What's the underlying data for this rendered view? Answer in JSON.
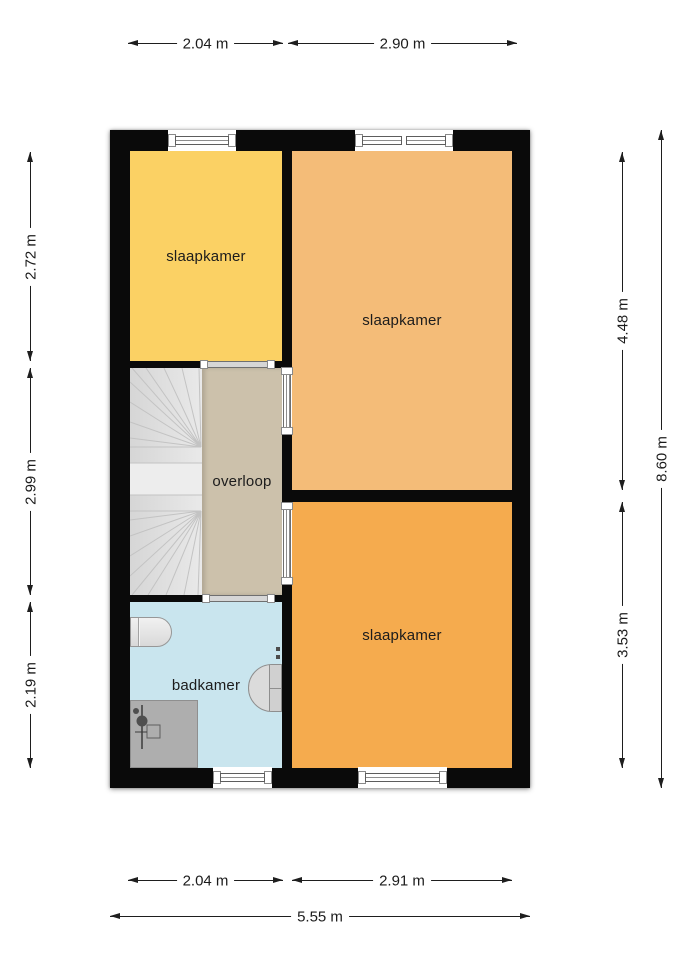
{
  "plan": {
    "type": "floor-plan",
    "wall_color": "#0a0a0a",
    "rooms": [
      {
        "id": "bedroom-top-left",
        "label": "slaapkamer",
        "color": "#fbd164"
      },
      {
        "id": "bedroom-top-right",
        "label": "slaapkamer",
        "color": "#f4bc78"
      },
      {
        "id": "bedroom-bottom-right",
        "label": "slaapkamer",
        "color": "#f5ab4e"
      },
      {
        "id": "landing",
        "label": "overloop",
        "color": "#ccc1ab"
      },
      {
        "id": "bathroom",
        "label": "badkamer",
        "color": "#c9e5ee"
      }
    ],
    "fixtures": [
      {
        "name": "stairs",
        "color": "#e0e0e0"
      },
      {
        "name": "toilet",
        "color": "#e3e3e3"
      },
      {
        "name": "washbasin",
        "color": "#dbdbdb"
      },
      {
        "name": "shower",
        "color": "#aeaeae"
      }
    ],
    "openings": {
      "windows": 4,
      "doors": 4
    }
  },
  "dimensions": {
    "top": [
      {
        "label": "2.04 m"
      },
      {
        "label": "2.90 m"
      }
    ],
    "left": [
      {
        "label": "2.72 m"
      },
      {
        "label": "2.99 m"
      },
      {
        "label": "2.19 m"
      }
    ],
    "right": [
      {
        "label": "4.48 m"
      },
      {
        "label": "3.53 m"
      }
    ],
    "right_total": {
      "label": "8.60 m"
    },
    "bottom": [
      {
        "label": "2.04 m"
      },
      {
        "label": "2.91 m"
      }
    ],
    "bottom_total": {
      "label": "5.55 m"
    }
  }
}
